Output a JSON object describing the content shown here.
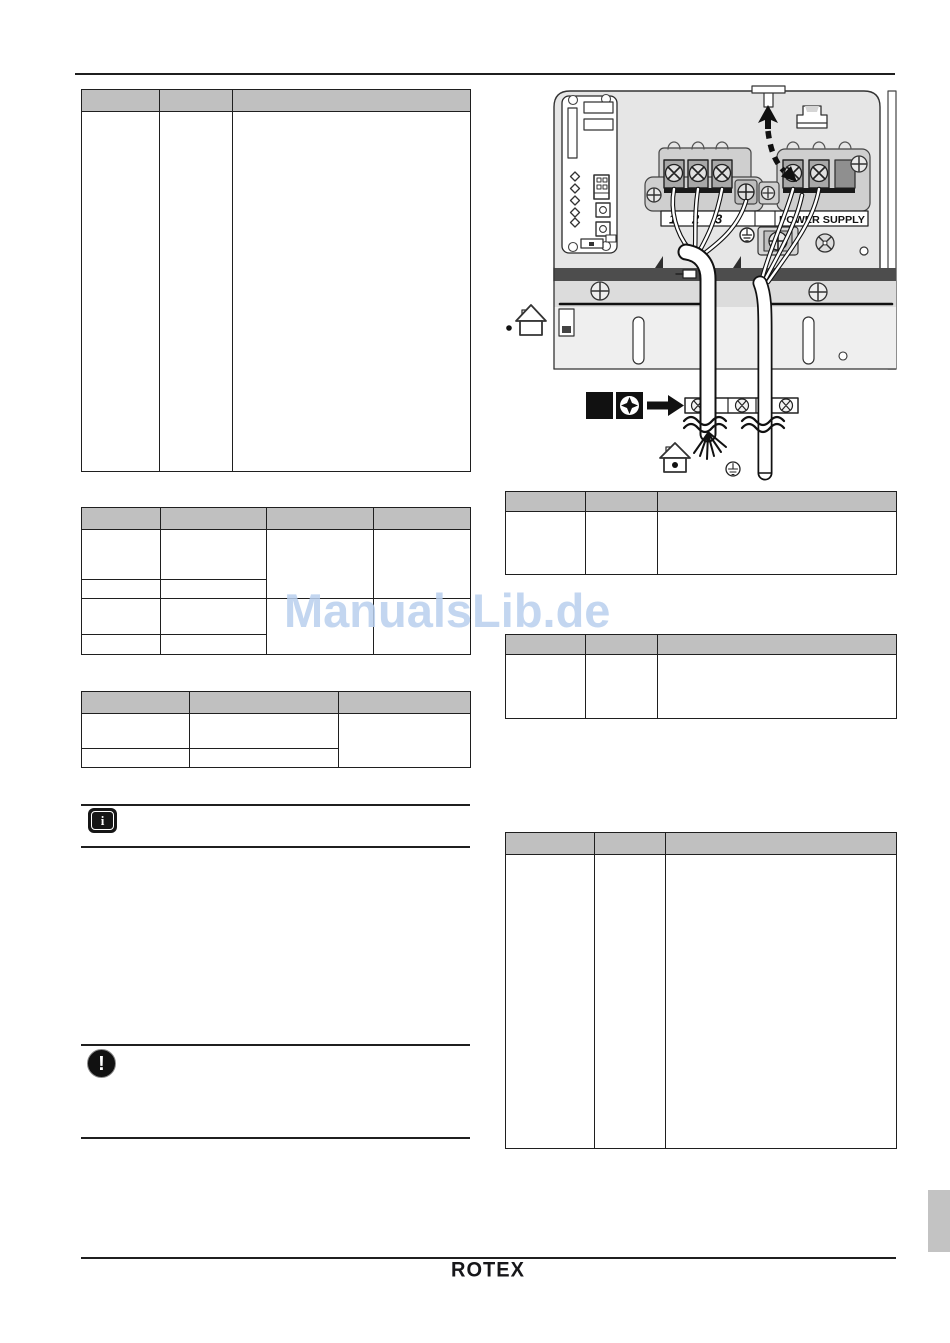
{
  "page": {
    "watermark_text": "ManualsLib.de",
    "watermark_color": "#b9d0ee",
    "footer_brand": "ROTEX",
    "table_header_color": "#c0c0c0"
  },
  "notes": {
    "info_icon_glyph": "i",
    "caution_icon_glyph": "!"
  },
  "diagram": {
    "power_supply_label": "POWER SUPPLY",
    "terminal_labels": {
      "t1": "1",
      "t2": "2",
      "t3": "3"
    }
  },
  "tables": {
    "left_table_1": {
      "header": [
        "",
        "",
        ""
      ],
      "rows": [
        [
          "",
          "",
          ""
        ]
      ]
    },
    "left_table_2": {
      "header": [
        "",
        "",
        "",
        ""
      ],
      "rows": [
        [
          "",
          "",
          "",
          ""
        ],
        [
          "",
          ""
        ],
        [
          "",
          "",
          "",
          ""
        ],
        [
          "",
          ""
        ]
      ]
    },
    "left_table_3": {
      "header": [
        "",
        "",
        ""
      ],
      "rows": [
        [
          "",
          "",
          ""
        ],
        [
          "",
          ""
        ]
      ]
    },
    "right_table_1": {
      "header": [
        "",
        "",
        ""
      ],
      "rows": [
        [
          "",
          "",
          ""
        ]
      ]
    },
    "right_table_2": {
      "header": [
        "",
        "",
        ""
      ],
      "rows": [
        [
          "",
          "",
          ""
        ]
      ]
    },
    "right_table_3": {
      "header": [
        "",
        "",
        ""
      ],
      "rows": [
        [
          "",
          "",
          ""
        ]
      ]
    }
  }
}
